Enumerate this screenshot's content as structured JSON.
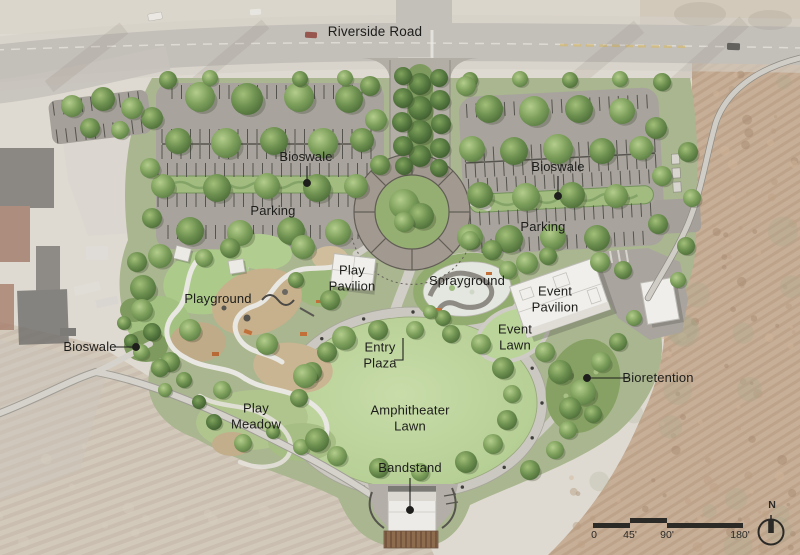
{
  "plan": {
    "road_label": "Riverside Road",
    "areas": {
      "bioswale_parking_left": "Bioswale",
      "parking_left": "Parking",
      "bioswale_parking_right": "Bioswale",
      "parking_right": "Parking",
      "play_pavilion": "Play\nPavilion",
      "sprayground": "Sprayground",
      "event_pavilion": "Event\nPavilion",
      "playground": "Playground",
      "event_lawn": "Event\nLawn",
      "bioswale_west": "Bioswale",
      "entry_plaza": "Entry\nPlaza",
      "bioretention": "Bioretention",
      "play_meadow": "Play\nMeadow",
      "amphitheater_lawn": "Amphitheater\nLawn",
      "bandstand": "Bandstand"
    },
    "scale_bar": {
      "ticks": [
        "0",
        "45'",
        "90'",
        "180'"
      ]
    },
    "north_label": "N",
    "colors": {
      "lawn": "#bcd49c",
      "tree": "#6f9150",
      "path": "#d1cec7",
      "asphalt": "#a8a49d",
      "plaza_ring": "#a29a90",
      "terrain": "#b99a7c",
      "label_text": "#1d1d1b"
    }
  }
}
